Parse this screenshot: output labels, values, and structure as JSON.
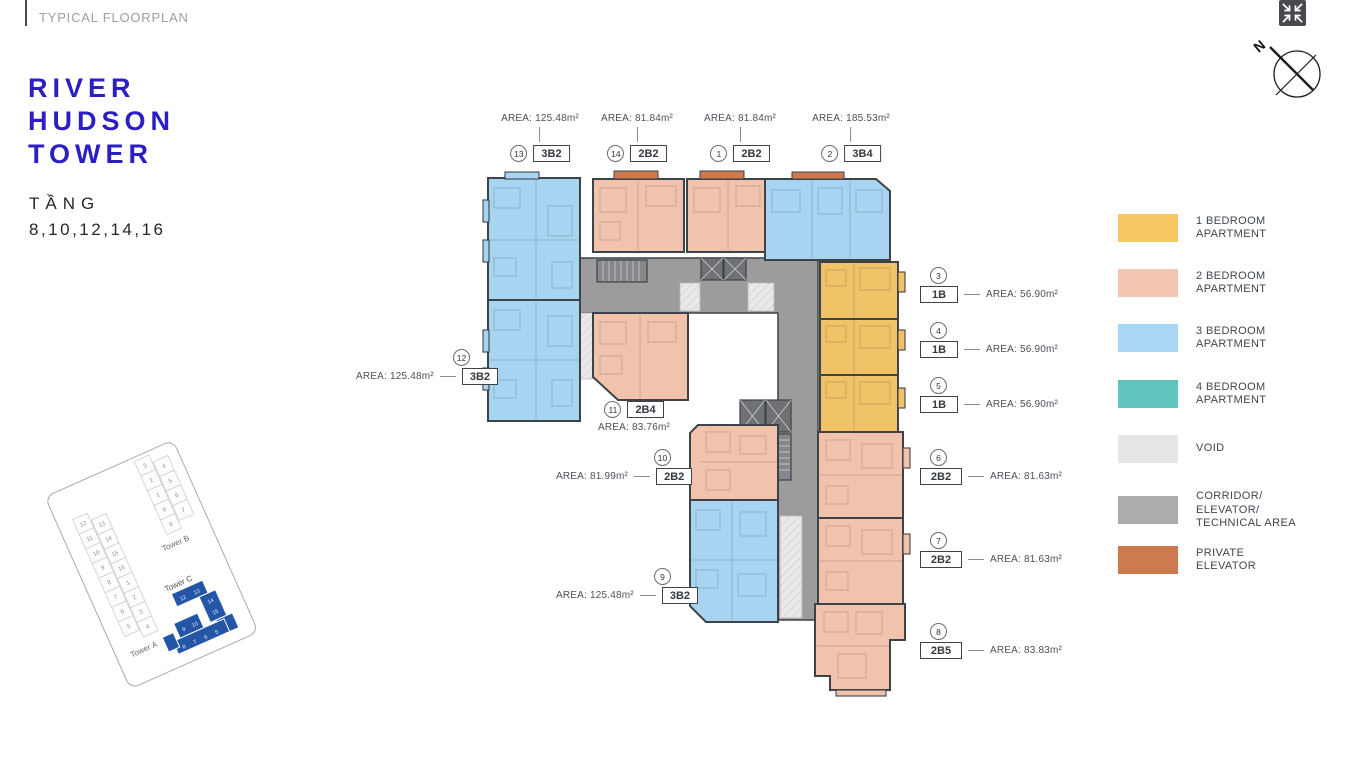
{
  "header": {
    "kicker": "TYPICAL FLOORPLAN"
  },
  "title": {
    "line1": "RIVER",
    "line2": "HUDSON",
    "line3": "TOWER",
    "floors_label": "TẦNG",
    "floors_value": "8,10,12,14,16"
  },
  "compass": {
    "north_label": "N"
  },
  "legend": {
    "items": [
      {
        "key": "1br",
        "label": "1 BEDROOM\nAPARTMENT",
        "color": "#F8C862"
      },
      {
        "key": "2br",
        "label": "2 BEDROOM\nAPARTMENT",
        "color": "#F3C6B0"
      },
      {
        "key": "3br",
        "label": "3 BEDROOM\nAPARTMENT",
        "color": "#A9D6F5"
      },
      {
        "key": "4br",
        "label": "4 BEDROOM\nAPARTMENT",
        "color": "#5FC5BE"
      },
      {
        "key": "void",
        "label": "VOID",
        "color": "#E6E6E6"
      },
      {
        "key": "corridor",
        "label": "CORRIDOR/\nELEVATOR/\nTECHNICAL AREA",
        "color": "#ACACAC"
      },
      {
        "key": "private-elevator",
        "label": "PRIVATE\nELEVATOR",
        "color": "#CE7A50"
      }
    ]
  },
  "units": [
    {
      "no": "13",
      "code": "3B2",
      "area": "AREA: 125.48m²",
      "type": "3br"
    },
    {
      "no": "14",
      "code": "2B2",
      "area": "AREA: 81.84m²",
      "type": "2br"
    },
    {
      "no": "1",
      "code": "2B2",
      "area": "AREA: 81.84m²",
      "type": "2br"
    },
    {
      "no": "2",
      "code": "3B4",
      "area": "AREA: 185.53m²",
      "type": "3br"
    },
    {
      "no": "3",
      "code": "1B",
      "area": "AREA: 56.90m²",
      "type": "1br"
    },
    {
      "no": "4",
      "code": "1B",
      "area": "AREA: 56.90m²",
      "type": "1br"
    },
    {
      "no": "5",
      "code": "1B",
      "area": "AREA: 56.90m²",
      "type": "1br"
    },
    {
      "no": "6",
      "code": "2B2",
      "area": "AREA: 81.63m²",
      "type": "2br"
    },
    {
      "no": "7",
      "code": "2B2",
      "area": "AREA: 81.63m²",
      "type": "2br"
    },
    {
      "no": "8",
      "code": "2B5",
      "area": "AREA: 83.83m²",
      "type": "2br"
    },
    {
      "no": "12",
      "code": "3B2",
      "area": "AREA: 125.48m²",
      "type": "3br"
    },
    {
      "no": "11",
      "code": "2B4",
      "area": "AREA: 83.76m²",
      "type": "2br"
    },
    {
      "no": "10",
      "code": "2B2",
      "area": "AREA: 81.99m²",
      "type": "2br"
    },
    {
      "no": "9",
      "code": "3B2",
      "area": "AREA: 125.48m²",
      "type": "3br"
    }
  ],
  "minimap": {
    "towers": [
      {
        "name": "Tower A",
        "highlighted": false,
        "left_column": [
          "12",
          "11",
          "10",
          "9",
          "8",
          "7",
          "6",
          "5"
        ],
        "right_column": [
          "13",
          "14",
          "15",
          "16",
          "1",
          "2",
          "3",
          "4"
        ]
      },
      {
        "name": "Tower B",
        "highlighted": false,
        "left_column": [
          "3",
          "2",
          "1",
          "8",
          "6"
        ],
        "right_column": [
          "4",
          "5",
          "6",
          "7"
        ]
      },
      {
        "name": "Tower C",
        "highlighted": true,
        "color": "#2456A8",
        "numbers": [
          "12",
          "13",
          "14",
          "15",
          "9",
          "10",
          "8",
          "7",
          "6",
          "5"
        ]
      }
    ]
  },
  "plan_colors": {
    "one_br": "#F0C368",
    "two_br": "#F2C3AC",
    "three_br": "#A7D4F1",
    "four_br": "#5FC5BE",
    "void": "#E9E9E9",
    "corridor": "#9C9C9C",
    "private_elevator": "#CE7A50",
    "walls": "#3E4347"
  }
}
